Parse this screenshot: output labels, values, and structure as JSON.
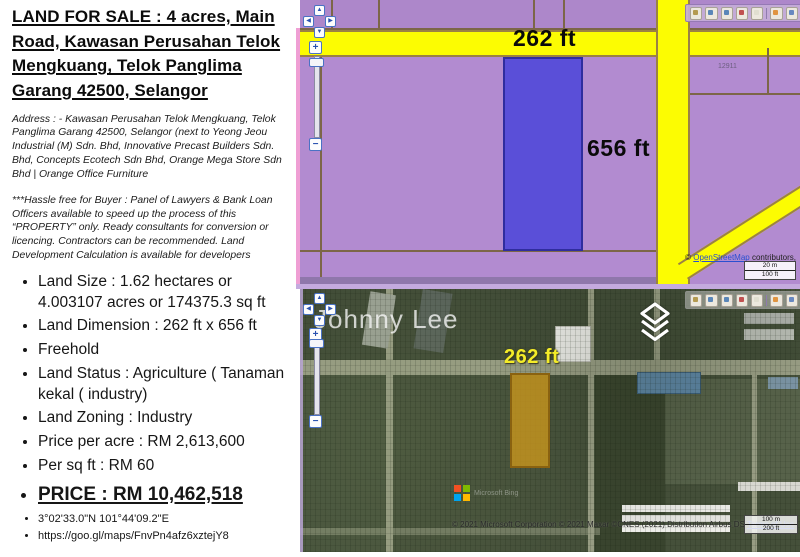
{
  "left_panel": {
    "title": "LAND  FOR  SALE : 4 acres, Main Road, Kawasan Perusahan Telok Mengkuang, Telok Panglima Garang 42500, Selangor",
    "address": "Address : - Kawasan Perusahan Telok Mengkuang, Telok Panglima Garang 42500,  Selangor (next to Yeong Jeou Industrial (M) Sdn. Bhd, Innovative Precast Builders Sdn. Bhd, Concepts Ecotech Sdn Bhd, Orange Mega Store Sdn Bhd | Orange Office Furniture",
    "note": "***Hassle free for Buyer :   Panel of Lawyers & Bank Loan Officers available to speed up the process of this “PROPERTY” only. Ready consultants for conversion or licencing. Contractors can be recommended. Land Development Calculation is available for developers",
    "bullets": [
      "Land Size : 1.62 hectares or 4.003107 acres or 174375.3 sq ft",
      "Land Dimension : 262 ft x 656 ft",
      "Freehold",
      "Land Status : Agriculture ( Tanaman kekal ( industry)",
      "Land Zoning : Industry",
      "Price per acre : RM 2,613,600",
      "Per sq ft  : RM 60"
    ],
    "price": "PRICE : RM 10,462,518",
    "coordinates": "3°02'33.0\"N 101°44'09.2\"E",
    "map_link": "https://goo.gl/maps/FnvPn4afz6xztejY8"
  },
  "map_controls": {
    "up": "▲",
    "down": "▼",
    "left": "◀",
    "right": "▶",
    "zoom_in": "+",
    "zoom_out": "−"
  },
  "toolbar_icons": [
    "pan-hand-icon",
    "zoom-window-icon",
    "find-icon",
    "locate-icon",
    "clear-icon",
    "measure-icon",
    "print-icon"
  ],
  "top_map": {
    "width_label": "262 ft",
    "height_label": "656 ft",
    "parcel_number": "12911",
    "attribution": {
      "prefix": "© ",
      "link": "OpenStreetMap",
      "suffix": " contributors,"
    },
    "scale": {
      "metric": "20 m",
      "imperial": "100 ft"
    }
  },
  "bottom_map": {
    "watermark": "Johnny Lee",
    "width_label": "262 ft",
    "logo_text": "Microsoft Bing",
    "attribution": "© 2021 Microsoft Corporation © 2021 Maxar ©CNES (2021) Distribution Airbus DS ",
    "terms_link": "Terms of Use",
    "scale": {
      "metric": "100 m",
      "imperial": "200 ft"
    }
  },
  "colors": {
    "map_purple": "#b28bd0",
    "road_yellow": "#fcfc02",
    "parcel_blue": "#5a4fd8",
    "parcel_orange": "#cd981c",
    "label_yellow": "#f4ec28",
    "satellite_green": "#45503a",
    "bing_red": "#f25022",
    "bing_green": "#7fba00",
    "bing_blue": "#00a4ef",
    "bing_yellow": "#ffb900"
  }
}
